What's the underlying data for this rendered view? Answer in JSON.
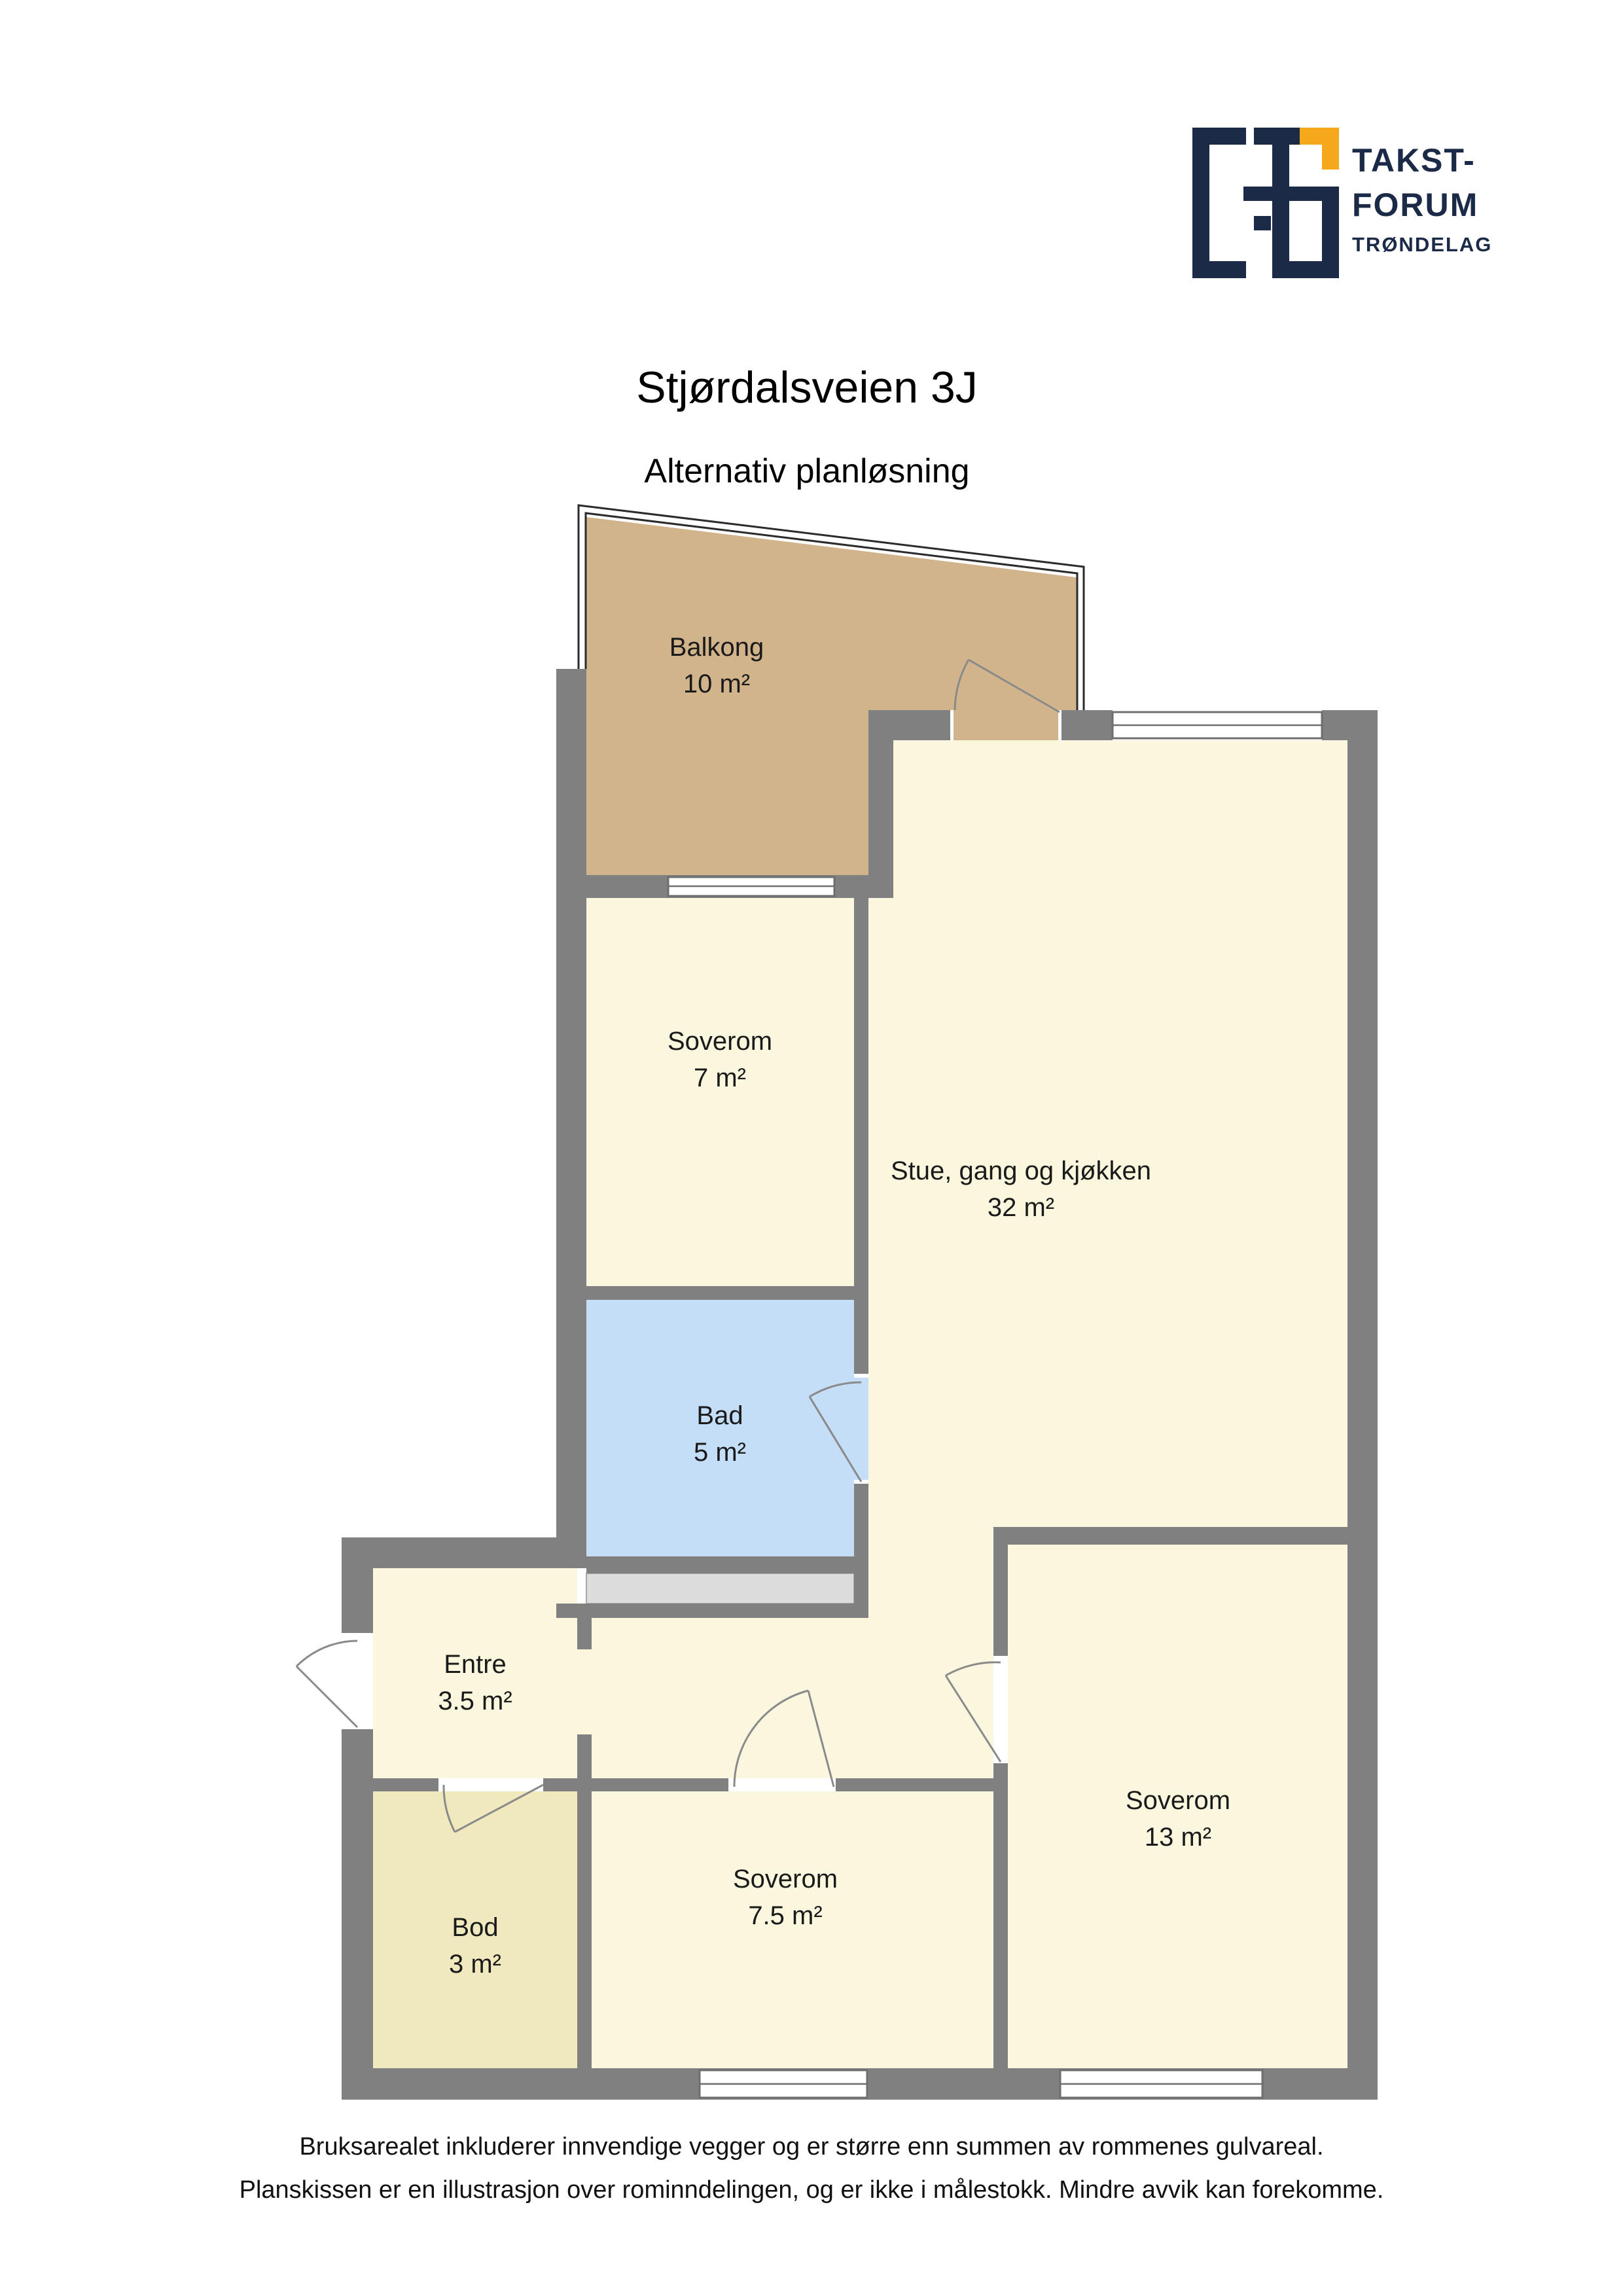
{
  "header": {
    "title": "Stjørdalsveien 3J",
    "subtitle": "Alternativ planløsning"
  },
  "logo": {
    "line1": "TAKST-",
    "line2": "FORUM",
    "line3": "TRØNDELAG"
  },
  "rooms": [
    {
      "id": "balkong",
      "name": "Balkong",
      "area": "10 m²",
      "color": "#D2B48C"
    },
    {
      "id": "soverom-7",
      "name": "Soverom",
      "area": "7 m²",
      "color": "#FBF7DF"
    },
    {
      "id": "stue",
      "name": "Stue, gang og kjøkken",
      "area": "32 m²",
      "color": "#FBF7DF"
    },
    {
      "id": "bad",
      "name": "Bad",
      "area": "5 m²",
      "color": "#C5DEF8"
    },
    {
      "id": "entre",
      "name": "Entre",
      "area": "3.5 m²",
      "color": "#FBF7DF"
    },
    {
      "id": "bod",
      "name": "Bod",
      "area": "3 m²",
      "color": "#F0E9BE"
    },
    {
      "id": "soverom-7-5",
      "name": "Soverom",
      "area": "7.5 m²",
      "color": "#FBF7DF"
    },
    {
      "id": "soverom-13",
      "name": "Soverom",
      "area": "13 m²",
      "color": "#FBF7DF"
    }
  ],
  "footer": {
    "line1": "Bruksarealet inkluderer innvendige vegger og er større enn summen av rommenes gulvareal.",
    "line2": "Planskissen er en illustrasjon over rominndelingen, og er ikke i målestokk. Mindre avvik kan forekomme."
  },
  "palette": {
    "wall": "#808080",
    "window_stroke": "#6E6E6E",
    "door_stroke": "#8A8A8A",
    "shaft": "#DCDCDC",
    "railing": "#2B2B2B",
    "text": "#1A1A1A",
    "logo_navy": "#1B2A47",
    "logo_orange": "#F5A81C"
  }
}
